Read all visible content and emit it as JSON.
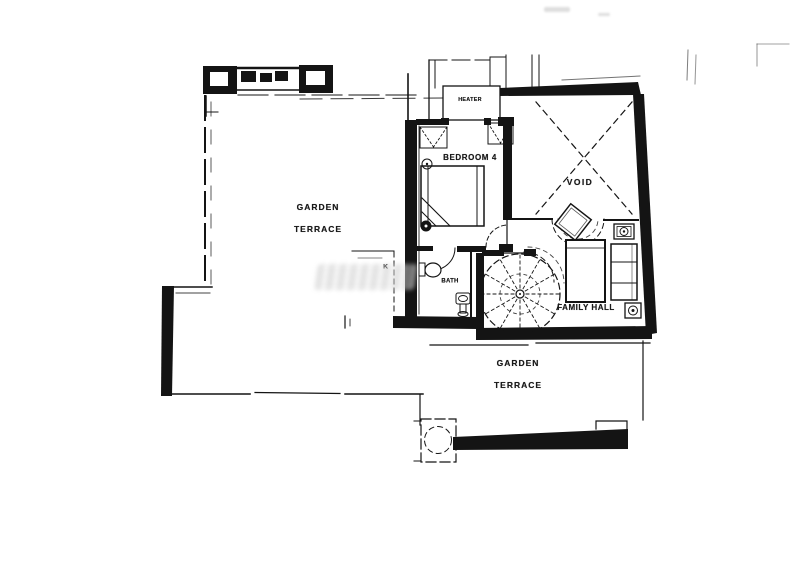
{
  "page": {
    "description_colors": {
      "paper": "#ffffff",
      "ink": "#141414",
      "watermark": "#c9c9c9"
    }
  },
  "labels": {
    "garden_terrace_upper": [
      "GARDEN",
      "TERRACE"
    ],
    "bedroom": "BEDROOM 4",
    "void": "VOID",
    "heater": "HEATER",
    "bath": "BATH",
    "family_hall": "FAMILY HALL",
    "garden_terrace_lower": [
      "GARDEN",
      "TERRACE"
    ],
    "k_mark": "K"
  },
  "symbols": {
    "spiral_staircase": "dashed-circle-with-radial-treads",
    "bed": "rectangle-with-folded-corner",
    "toilet": "tank-and-bowl-ellipse",
    "sink": "pedestal-sink",
    "void_cross": "dashed-x-brace",
    "door_swing": "quarter-arc",
    "parapet": "castellated-wall"
  }
}
